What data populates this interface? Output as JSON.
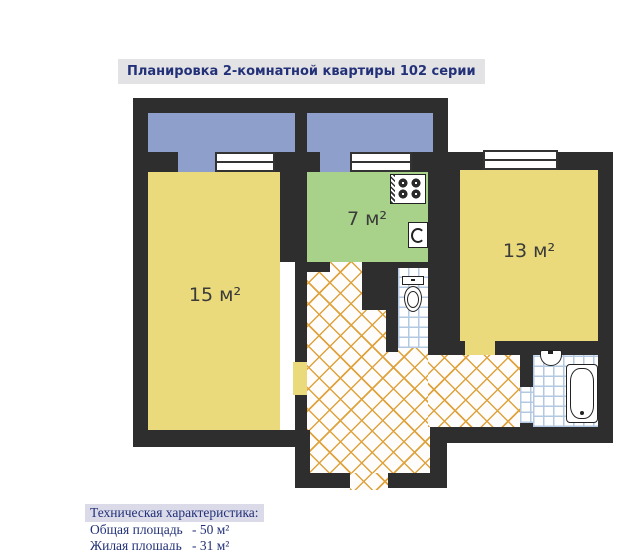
{
  "title": "Планировка 2-комнатной квартиры 102 серии",
  "plan": {
    "rooms": [
      {
        "name": "room-15",
        "area_label": "15 м²"
      },
      {
        "name": "kitchen",
        "area_label": "7 м²"
      },
      {
        "name": "room-13",
        "area_label": "13 м²"
      }
    ],
    "fixtures": [
      "stove",
      "kitchen-sink",
      "toilet",
      "washbasin",
      "bathtub"
    ],
    "floor_types": [
      "balcony",
      "living-room",
      "kitchen",
      "parquet-hallway",
      "tiled-wc",
      "tiled-bathroom"
    ]
  },
  "tech": {
    "heading": "Техническая характеристика:",
    "rows": [
      {
        "label": "Общая площадь",
        "value": "- 50 м²"
      },
      {
        "label": "Жилая площадь",
        "value": "- 31 м²"
      }
    ]
  },
  "colors": {
    "wall": "#2e2e2e",
    "balcony": "#8f9fcc",
    "room": "#ebda7b",
    "kitchen": "#a8d189",
    "parquet-line": "#dfa23c",
    "tile-line": "#b3c9e2",
    "text-navy": "#233178",
    "title-bg": "#e3e3e5",
    "heading-bg": "#dadae8"
  }
}
